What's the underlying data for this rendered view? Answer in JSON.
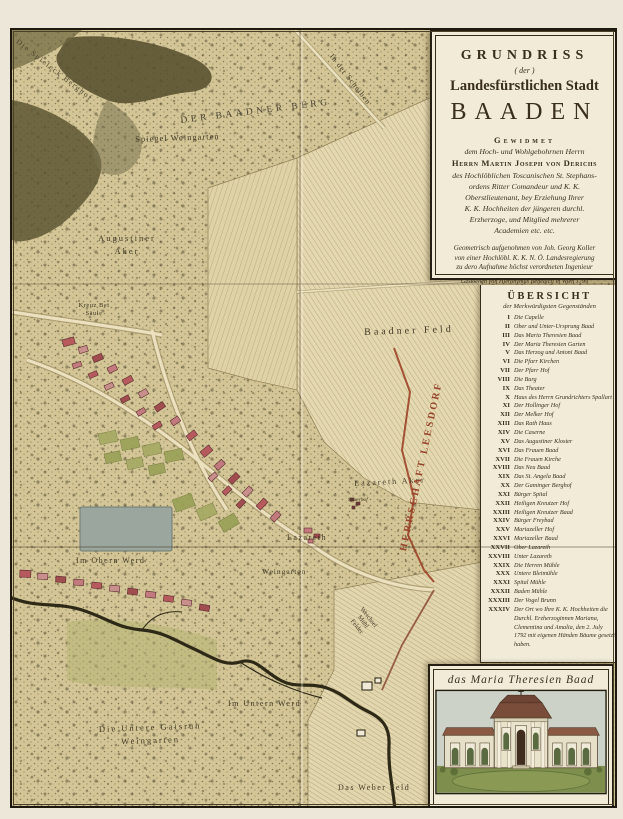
{
  "colors": {
    "parchment": "#d4c79a",
    "paper": "#f1ebd8",
    "ink": "#3a2f1c",
    "boundary_red": "#9c4228",
    "herrschaft_red": "#97432b",
    "building_red": "#b65a5e",
    "garden_green": "#a6aa64",
    "pond_grey": "#9aa69e"
  },
  "cartouche": {
    "title": "GRUNDRISS",
    "title_der": "( der )",
    "title_line2": "Landesfürstlichen Stadt",
    "city": "BAADEN",
    "dedication_heading": "Gewidmet",
    "dedication_to": "dem Hoch- und Wohlgebohrnen Herrn",
    "dedicatee": "Herrn Martin Joseph von Derichs",
    "dedication_lines": [
      "des Hochlöblichen Toscanischen St. Stephans-",
      "ordens Ritter Comandeur und K. K.",
      "Oberstlieutenant, bey Erziehung Ihrer",
      "K. K. Hochheiten der jüngeren durchl.",
      "Erzherzoge, und Mitglied mehrerer",
      "Academien etc. etc."
    ],
    "surveyor_lines": [
      "Geometrisch aufgenohmen von Joh. Georg Koller",
      "von einer Hochlöbl. K. K. N. Ö. Landesregierung",
      "zu dero Aufnahme höchst verordneten Ingenieur"
    ],
    "engraver": "Gestochen von Hieronymus Benedicti in Wien 1799"
  },
  "legend": {
    "title": "ÜBERSICHT",
    "subtitle": "der Merkwürdigsten Gegenständen",
    "items": [
      {
        "num": "I",
        "name": "Die Capelle"
      },
      {
        "num": "II",
        "name": "Ober und Unter-Ursprung Baad"
      },
      {
        "num": "III",
        "name": "Das Maria Theresien Baad"
      },
      {
        "num": "IV",
        "name": "Der Maria Theresien Garten"
      },
      {
        "num": "V",
        "name": "Das Herzog und Antoni Baad"
      },
      {
        "num": "VI",
        "name": "Die Pfarr Kirchen"
      },
      {
        "num": "VII",
        "name": "Der Pfarr Hof"
      },
      {
        "num": "VIII",
        "name": "Die Burg"
      },
      {
        "num": "IX",
        "name": "Das Theater"
      },
      {
        "num": "X",
        "name": "Haus des Herrn Grundrichters Spallart"
      },
      {
        "num": "XI",
        "name": "Der Hollinger Hof"
      },
      {
        "num": "XII",
        "name": "Der Melker Hof"
      },
      {
        "num": "XIII",
        "name": "Das Rath Haus"
      },
      {
        "num": "XIV",
        "name": "Die Caserne"
      },
      {
        "num": "XV",
        "name": "Das Augustiner Kloster"
      },
      {
        "num": "XVI",
        "name": "Das Frauen Baad"
      },
      {
        "num": "XVII",
        "name": "Die Frauen Kirche"
      },
      {
        "num": "XVIII",
        "name": "Das Neu Baad"
      },
      {
        "num": "XIX",
        "name": "Das St. Angela Baad"
      },
      {
        "num": "XX",
        "name": "Der Gaminger Berghof"
      },
      {
        "num": "XXI",
        "name": "Bürger Spital"
      },
      {
        "num": "XXII",
        "name": "Heiligen Kreutzer Hof"
      },
      {
        "num": "XXIII",
        "name": "Heiligen Kreutzer Baad"
      },
      {
        "num": "XXIV",
        "name": "Bürger Freybad"
      },
      {
        "num": "XXV",
        "name": "Mariazeller Hof"
      },
      {
        "num": "XXVI",
        "name": "Mariazeller Baad"
      },
      {
        "num": "XXVII",
        "name": "Ober Lazareth"
      },
      {
        "num": "XXVIII",
        "name": "Unter Lazareth"
      },
      {
        "num": "XXIX",
        "name": "Die Herren Mühle"
      },
      {
        "num": "XXX",
        "name": "Untere Bleimühle"
      },
      {
        "num": "XXXI",
        "name": "Spital Mühle"
      },
      {
        "num": "XXXII",
        "name": "Baden Mühle"
      },
      {
        "num": "XXXIII",
        "name": "Der Vogel Brunn"
      },
      {
        "num": "XXXIV",
        "name": "Der Ort wo Ihre K. K. Hochheiten die Durchl. Erzherzoginnen Mariana, Clementina und Amalia, den 2. July 1792 mit eigenen Händen Bäume gesetzt haben."
      }
    ]
  },
  "picture": {
    "caption": "das Maria Theresien Baad"
  },
  "map": {
    "labels": {
      "spieleck": "Die Spieleck Berghof",
      "berg": "DER BAADNER BERG",
      "spiegel": "Spiegel Weingarten",
      "scheiben": "In der Scheiben",
      "augustiner": "Augustiner\nAker",
      "kreuzbet": "Kreuz Bet\nSäule",
      "baadner_feld": "Baadner Feld",
      "lazareth_aker": "Lazareth Aker",
      "sauerhof": "Sauerhof",
      "lazareth": "Lazareth",
      "obern_werd": "Im Obern Werd",
      "weingarten": "Weingarten",
      "weichsel": "Weichsel\nMühl\nFelder",
      "herrschaft": "HERRSCHAFT LEESDORF",
      "untern_werd": "Im Untern Werd",
      "gaisruh": "Die Untere Gaisruh\nWeingarten",
      "weber_feld": "Das Weber Feld"
    }
  }
}
